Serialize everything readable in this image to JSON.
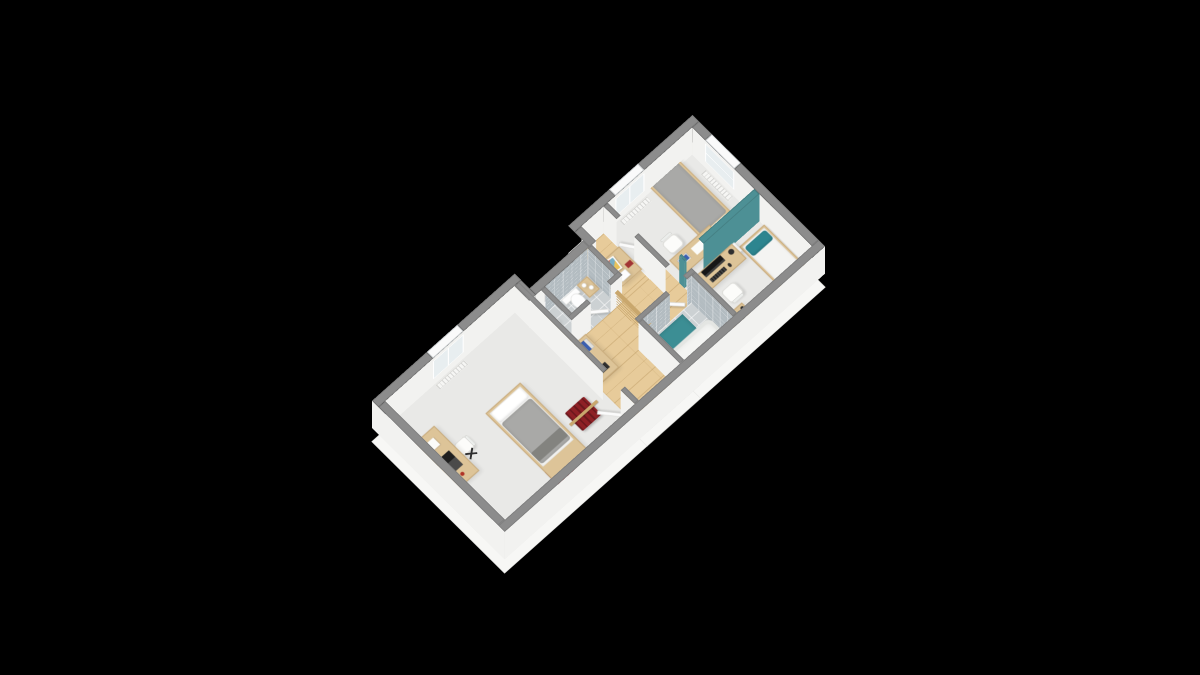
{
  "scene": {
    "type": "3d-floorplan-isometric-render",
    "description": "Furnished upper-floor cutaway floor plan rendered on black background",
    "background": "#000000"
  },
  "projection": {
    "translate_x": 372,
    "translate_y": 428,
    "scale": 0.47,
    "rotate_x_deg": 20,
    "rotate_z_deg": -43.5,
    "wall_height": 170
  },
  "palette": {
    "background": "#000000",
    "wall_top": "#8c8c8c",
    "wall_face": "#f2f2f0",
    "slab": "#f7f7f5",
    "room_floor": "#e9e9e7",
    "wood_floor": "#e7cb9a",
    "wood_furniture": "#ddc498",
    "wood_dark": "#c9a76d",
    "tile_floor": "#ccd1d3",
    "tile_wall": "#b3bcc1",
    "teal": "#4d9095",
    "teal_dark": "#3c8e94",
    "teal_pillow": "#2d858f",
    "duvet_gray": "#a9a9a7",
    "linen_white": "#f4f4f2",
    "cloth_red": "#8e2025",
    "device_dark": "#2e2e2e",
    "book_blue": "#3a5fb0",
    "door_white": "#fbfbfb"
  },
  "rooms": [
    {
      "name": "bedroom-top",
      "furniture": [
        "single-bed-gray-duvet",
        "desk-with-books",
        "white-chair",
        "white-nightstand",
        "radiator",
        "window"
      ]
    },
    {
      "name": "bedroom-right",
      "furniture": [
        "single-bed-white-teal-pillow",
        "desk-with-monitor-keyboard",
        "white-chair",
        "white-nightstand",
        "wood-side-table-laptop",
        "radiator",
        "window"
      ]
    },
    {
      "name": "bedroom-left",
      "furniture": [
        "single-bed-gray-duvet",
        "desk-with-laptop",
        "white-chair",
        "folding-stool",
        "clothes-rack-red",
        "clothes-rack-red",
        "radiator",
        "window"
      ]
    },
    {
      "name": "bathroom",
      "furniture": [
        "bathtub",
        "pedestal-sink",
        "teal-bath-mat",
        "door-ajar"
      ]
    },
    {
      "name": "wc",
      "furniture": [
        "toilet",
        "toilet-roll-shelf",
        "door-ajar"
      ]
    },
    {
      "name": "hallway",
      "furniture": [
        "wood-cabinet-picture-frame",
        "sideboard-with-books",
        "staircase-with-balustrade",
        "doors"
      ]
    }
  ],
  "counts": {
    "bedrooms": 3,
    "windows": 3,
    "door_leaves": 5,
    "teal_partition_walls": 1
  }
}
